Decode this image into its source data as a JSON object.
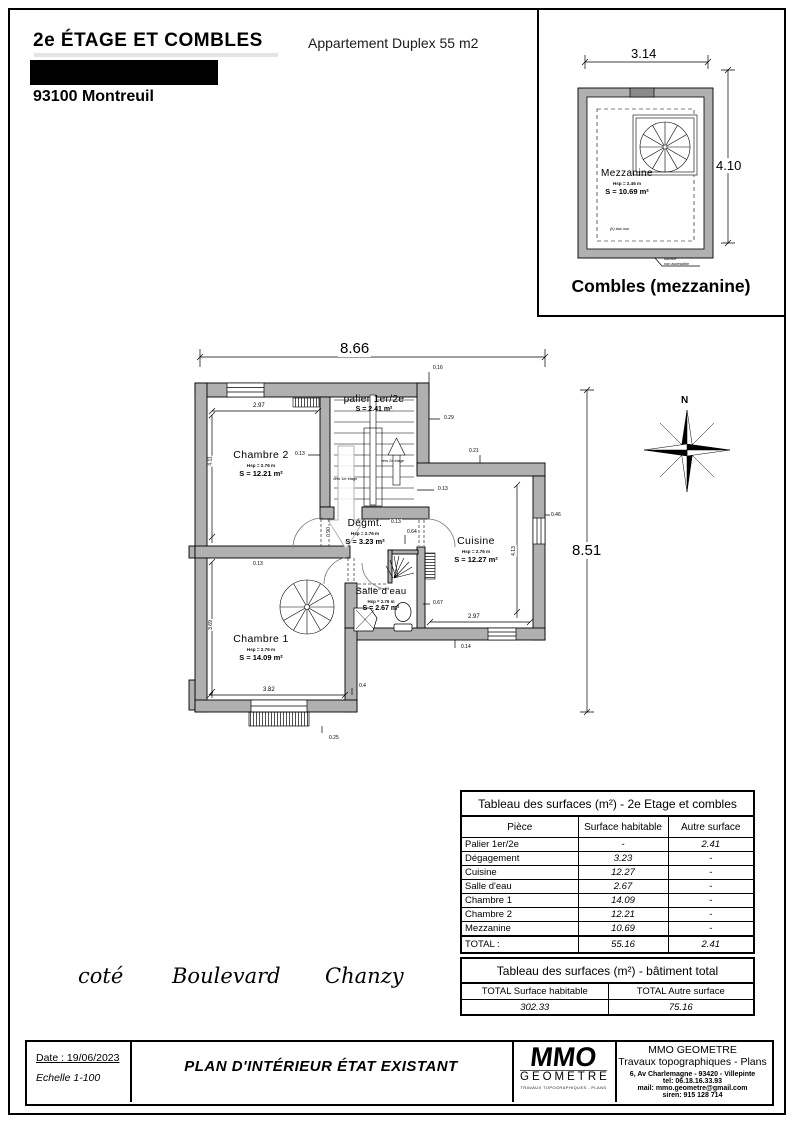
{
  "header": {
    "title": "2e ÉTAGE ET COMBLES",
    "subtitle": "Appartement Duplex 55 m2",
    "city": "93100 Montreuil"
  },
  "combles": {
    "caption": "Combles (mezzanine)",
    "room": "Mezzanine",
    "hsp": "Hsp = 2.46 m",
    "surface": "S = 10.69 m²",
    "note_low_wall": "(h) bas mur",
    "note_leader_1": "surface",
    "note_leader_2": "non accessible",
    "dim_width": "3.14",
    "dim_height": "4.10"
  },
  "plan": {
    "dim_top": "8.66",
    "dim_right": "8.51",
    "north": "N",
    "rooms": {
      "chambre2": {
        "name": "Chambre 2",
        "hsp": "Hsp = 2.76 m",
        "s": "S = 12.21 m²"
      },
      "palier": {
        "name": "palier 1er/2e",
        "s": "S = 2.41 m²"
      },
      "degagement": {
        "name": "Dégmt.",
        "hsp": "Hsp = 2.76 m",
        "s": "S = 3.23 m²"
      },
      "cuisine": {
        "name": "Cuisine",
        "hsp": "Hsp = 2.76 m",
        "s": "S = 12.27 m²"
      },
      "salle_eau": {
        "name": "Salle d'eau",
        "hsp": "Hsp = 2.76 m",
        "s": "S = 2.67 m²"
      },
      "chambre1": {
        "name": "Chambre 1",
        "hsp": "Hsp = 2.76 m",
        "s": "S = 14.09 m²"
      }
    },
    "stairs": {
      "up": "vers 2e étage",
      "down": "vers 1er étage"
    },
    "dims": {
      "c2_top": "2.97",
      "c2_left": "4.11",
      "d016": "0.16",
      "d029": "0.29",
      "d021": "0.21",
      "d013a": "0.13",
      "d013b": "0.13",
      "d013c": "0.13",
      "d013d": "0.13",
      "d064": "0.64",
      "d067": "0.67",
      "d090": "0.90",
      "d046": "0.46",
      "cu_bottom": "2.97",
      "cu_right": "4.13",
      "d014": "0.14",
      "c1_bottom": "3.82",
      "c1_left": "3.69",
      "d04": "0.4",
      "d025": "0.25"
    }
  },
  "street": {
    "w1": "coté",
    "w2": "Boulevard",
    "w3": "Chanzy"
  },
  "tables": {
    "surfaces": {
      "title": "Tableau des surfaces (m²) -  2e Etage et combles",
      "col_piece": "Pièce",
      "col_hab": "Surface habitable",
      "col_autre": "Autre surface",
      "rows": [
        {
          "piece": "Palier 1er/2e",
          "hab": "-",
          "autre": "2.41"
        },
        {
          "piece": "Dégagement",
          "hab": "3.23",
          "autre": "-"
        },
        {
          "piece": "Cuisine",
          "hab": "12.27",
          "autre": "-"
        },
        {
          "piece": "Salle d'eau",
          "hab": "2.67",
          "autre": "-"
        },
        {
          "piece": "Chambre 1",
          "hab": "14.09",
          "autre": "-"
        },
        {
          "piece": "Chambre 2",
          "hab": "12.21",
          "autre": "-"
        },
        {
          "piece": "Mezzanine",
          "hab": "10.69",
          "autre": "-"
        }
      ],
      "total_label": "TOTAL  :",
      "total_hab": "55.16",
      "total_autre": "2.41"
    },
    "building": {
      "title": "Tableau des surfaces (m²) -  bâtiment total",
      "col_hab": "TOTAL Surface habitable",
      "col_autre": "TOTAL Autre surface",
      "hab": "302.33",
      "autre": "75.16"
    }
  },
  "footer": {
    "date": "Date : 19/06/2023",
    "scale": "Echelle  1-100",
    "plan_title": "PLAN D'INTÉRIEUR ÉTAT EXISTANT",
    "logo_text": "MMO",
    "logo_sub": "GEOMETRE",
    "logo_tag": "TRAVAUX TOPOGRAPHIQUES - PLANS",
    "company": "MMO GEOMETRE",
    "activity": "Travaux topographiques - Plans",
    "address": "6, Av Charlemagne - 93420 - Villepinte",
    "tel": "tel: 06.18.16.33.93",
    "mail": "mail: mmo.geometre@gmail.com",
    "siren": "siren: 915 128 714"
  },
  "colors": {
    "wall_fill": "#b0b0b0",
    "ink": "#000000"
  }
}
